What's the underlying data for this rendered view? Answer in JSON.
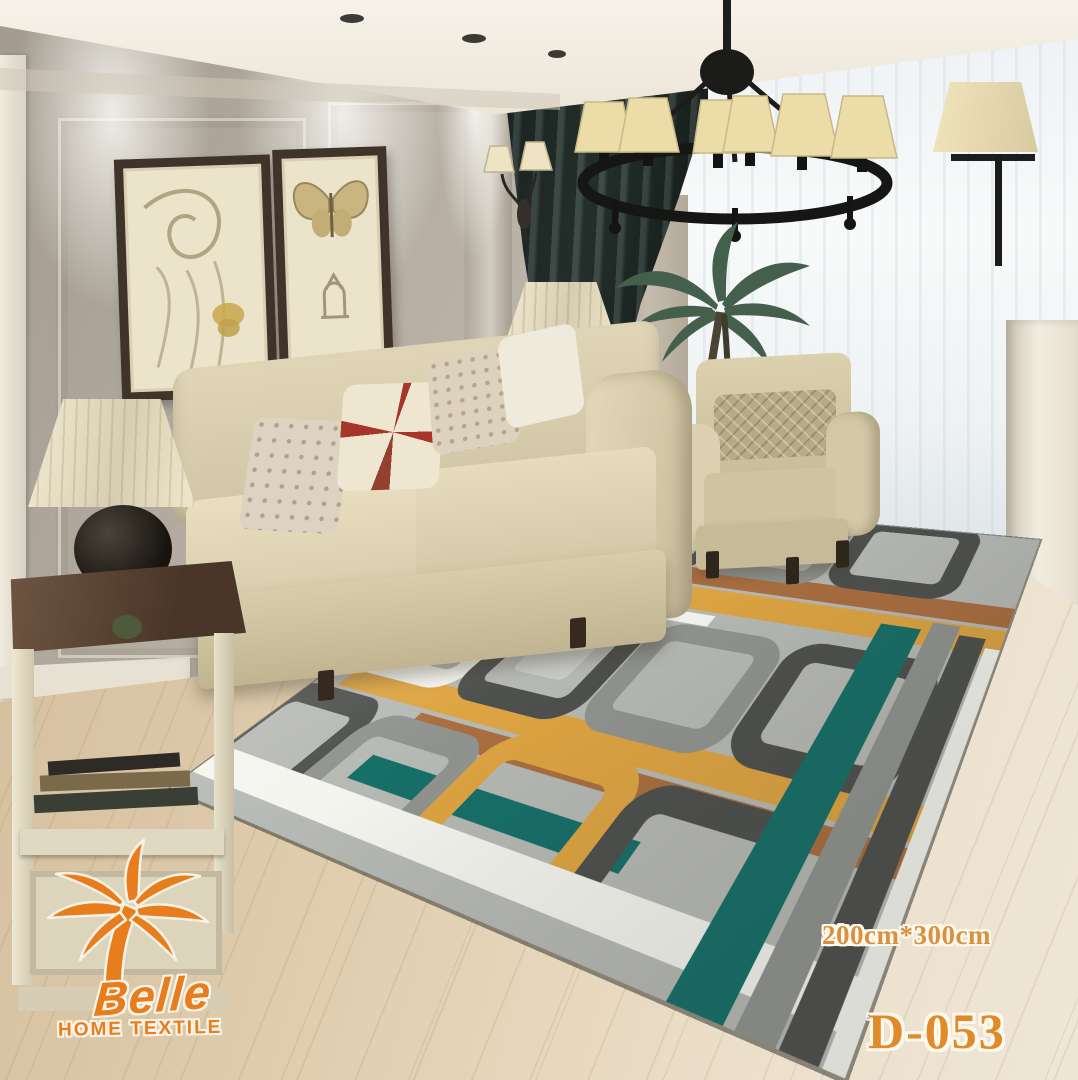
{
  "image_type": "product-photo of area rug in staged living room",
  "logo": {
    "brand": "Belle",
    "tagline": "HOME TEXTILE",
    "icon": "palm-tree-icon",
    "color": "#e87d1e"
  },
  "size_panel": {
    "label": "Size:",
    "sizes": [
      "160cm*220cm",
      "180cm*270cm",
      "200cm*300cm"
    ],
    "color": "#d8913f"
  },
  "model_code": "D-053",
  "colors": {
    "overlay_orange": "#e87d1e",
    "size_text_orange": "#d8913f",
    "model_text_orange": "#e08a28",
    "wall_greige": "#b5ada1",
    "curtain_dark_teal": "#2a3531",
    "floor_wood": "#e2d1b3",
    "sofa_cream": "#dcd2b3",
    "rug_palette": {
      "background_gray": "#b7b9b5",
      "dark_gray": "#4e504e",
      "mid_gray": "#90938f",
      "white": "#f5f5f0",
      "teal": "#166f68",
      "mustard": "#dea442",
      "brown": "#aa6e40"
    }
  }
}
